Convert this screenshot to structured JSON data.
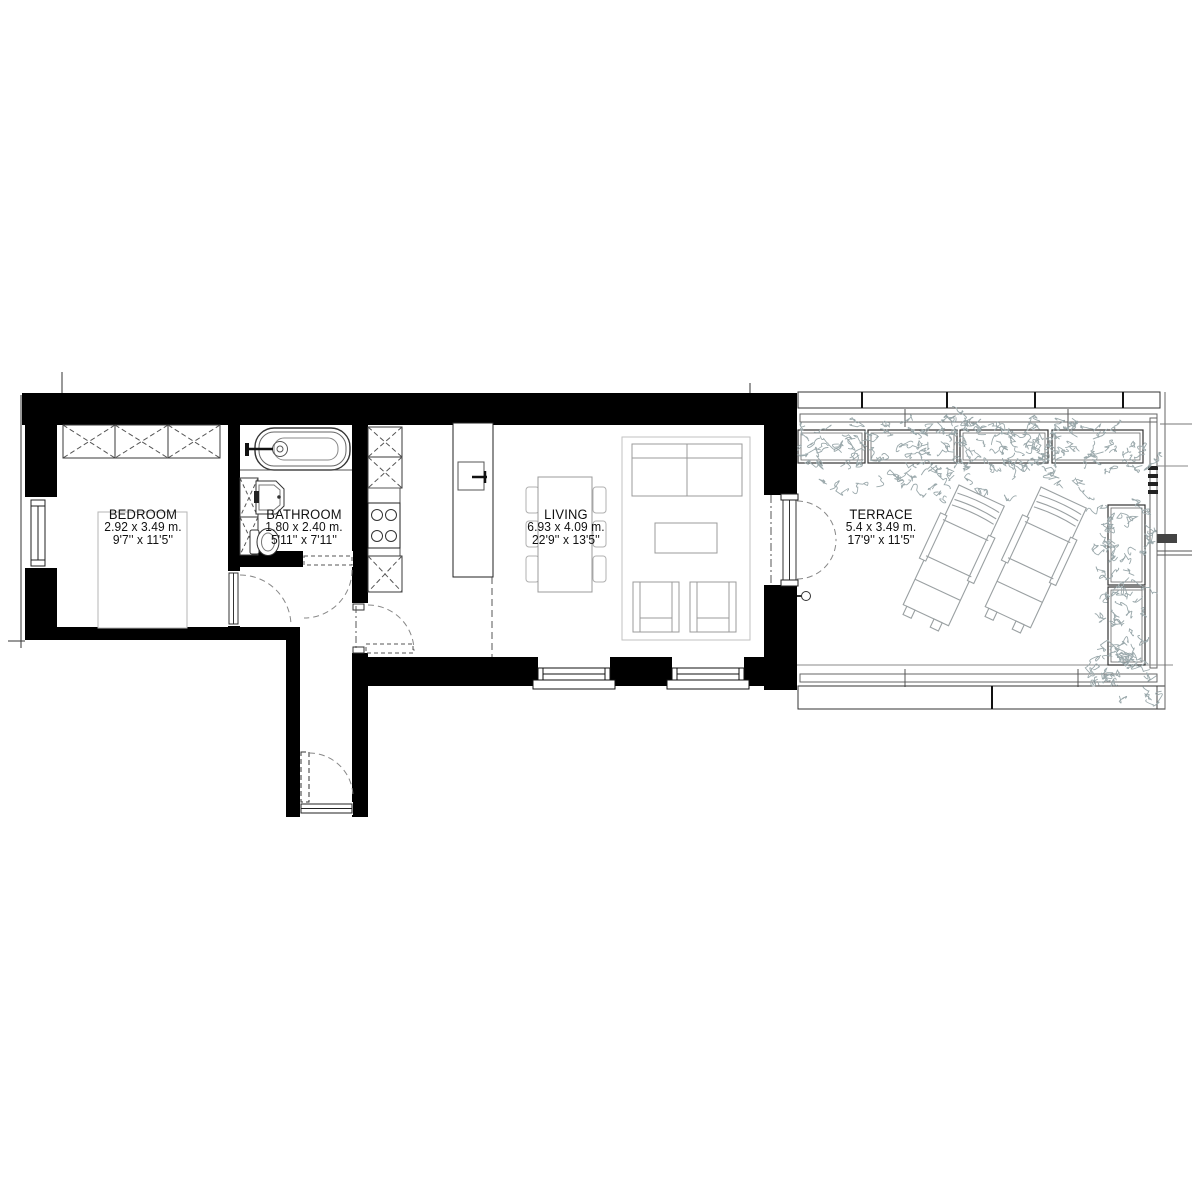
{
  "plan": {
    "rooms": [
      {
        "name": "BEDROOM",
        "metric": "2.92 x 3.49 m.",
        "imperial": "9'7'' x 11'5''"
      },
      {
        "name": "BATHROOM",
        "metric": "1.80 x 2.40 m.",
        "imperial": "5'11'' x 7'11''"
      },
      {
        "name": "LIVING",
        "metric": "6.93 x 4.09 m.",
        "imperial": "22'9'' x 13'5''"
      },
      {
        "name": "TERRACE",
        "metric": "5.4 x 3.49 m.",
        "imperial": "17'9'' x 11'5''"
      }
    ],
    "colors": {
      "walls": "#000000",
      "fixtures": "#3d3d3d",
      "furniture": "#9b9b9b",
      "light_furniture": "#bdbdbd",
      "vegetation": "#9aa8ab"
    }
  }
}
